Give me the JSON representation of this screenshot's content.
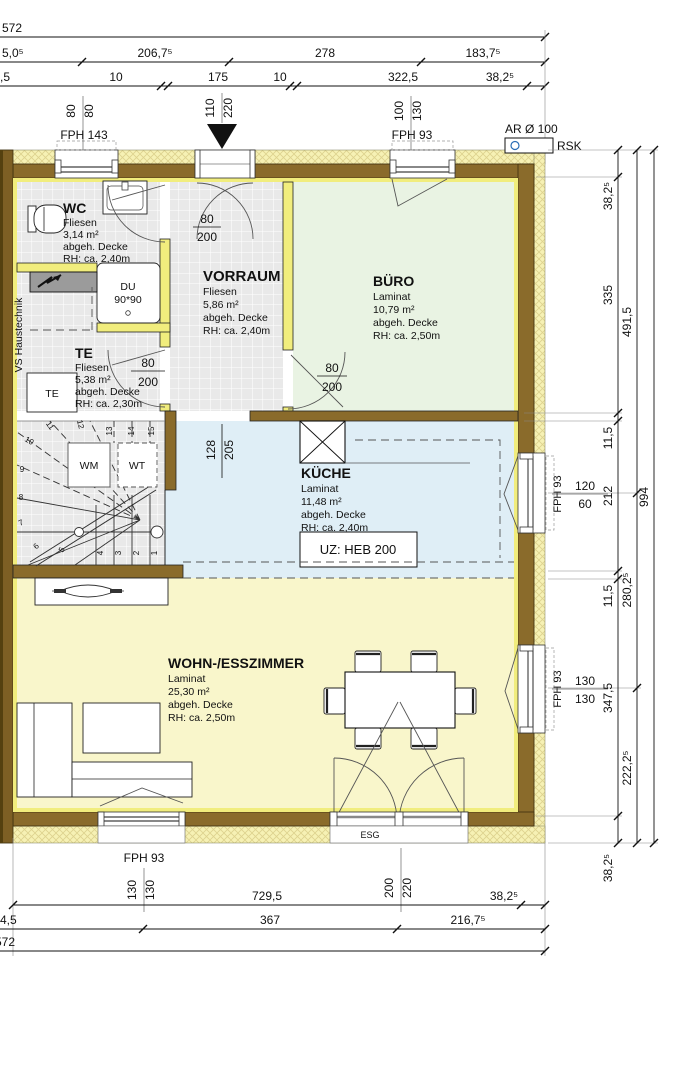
{
  "dims": {
    "top": {
      "row1_total": "572",
      "row2": [
        "5,0⁵",
        "206,7⁵",
        "278",
        "183,7⁵"
      ],
      "row3": [
        ",5",
        "10",
        "175",
        "10",
        "322,5",
        "38,2⁵"
      ]
    },
    "bottom": {
      "row1": [
        "729,5",
        "38,2⁵"
      ],
      "row2": [
        "4,5",
        "367",
        "216,7⁵"
      ],
      "row3_total": "572"
    },
    "right": {
      "inner": [
        "38,2⁵",
        "335",
        "11,5",
        "212",
        "11,5",
        "347,5",
        "38,2⁵"
      ],
      "middle": [
        "491,5",
        "280,2⁵",
        "222,2⁵"
      ],
      "outer_total": "994"
    }
  },
  "openings": {
    "top_window_left": {
      "label": "FPH 143",
      "width": "80",
      "height": "80"
    },
    "entry_door": {
      "width": "110",
      "height": "220"
    },
    "top_window_right": {
      "label": "FPH 93",
      "width": "100",
      "height": "130"
    },
    "vent": {
      "label": "AR Ø 100",
      "code": "RSK"
    },
    "right_window_kitchen": {
      "label": "FPH 93",
      "width": "120",
      "height": "60"
    },
    "right_window_living": {
      "label": "FPH 93",
      "width": "130",
      "height": "130"
    },
    "bottom_window": {
      "label": "FPH 93",
      "width": "130",
      "height": "130"
    },
    "terrace_door": {
      "label": "ESG",
      "width": "200",
      "height": "220"
    },
    "door_wc": {
      "width": "80",
      "height": "200"
    },
    "door_te": {
      "width": "80",
      "height": "200"
    },
    "door_buero": {
      "width": "80",
      "height": "200"
    },
    "passage_kueche": {
      "width": "128",
      "height": "205"
    }
  },
  "rooms": {
    "wc": {
      "name": "WC",
      "floor": "Fliesen",
      "area": "3,14 m²",
      "ceiling": "abgeh. Decke",
      "height": "RH: ca. 2,40m"
    },
    "vorraum": {
      "name": "VORRAUM",
      "floor": "Fliesen",
      "area": "5,86 m²",
      "ceiling": "abgeh. Decke",
      "height": "RH: ca. 2,40m"
    },
    "buero": {
      "name": "BÜRO",
      "floor": "Laminat",
      "area": "10,79 m²",
      "ceiling": "abgeh. Decke",
      "height": "RH: ca. 2,50m"
    },
    "te": {
      "name": "TE",
      "floor": "Fliesen",
      "area": "5,38 m²",
      "ceiling": "abgeh. Decke",
      "height": "RH: ca. 2,30m"
    },
    "kueche": {
      "name": "KÜCHE",
      "floor": "Laminat",
      "area": "11,48 m²",
      "ceiling": "abgeh. Decke",
      "height": "RH: ca. 2,40m"
    },
    "wohnen": {
      "name": "WOHN-/ESSZIMMER",
      "floor": "Laminat",
      "area": "25,30 m²",
      "ceiling": "abgeh. Decke",
      "height": "RH: ca. 2,50m"
    }
  },
  "annotations": {
    "haustechnik": "VS Haustechnik",
    "shower_line1": "DU",
    "shower_line2": "90*90",
    "te_box": "TE",
    "wm": "WM",
    "wt": "WT",
    "beam": "UZ: HEB 200"
  },
  "stairs": {
    "steps": [
      "1",
      "2",
      "3",
      "4",
      "5",
      "6",
      "7",
      "8",
      "9",
      "10",
      "11",
      "12",
      "13",
      "14",
      "15"
    ]
  },
  "colors": {
    "wall_brown": "#8a6b2b",
    "insulation": "#f6f1b4",
    "partition": "#f1ed7d",
    "floor_buero": "#e9f3e3",
    "floor_kueche": "#dfeef6",
    "floor_wohnen": "#f9f6cb",
    "floor_tiles": "#e9e9e9"
  }
}
